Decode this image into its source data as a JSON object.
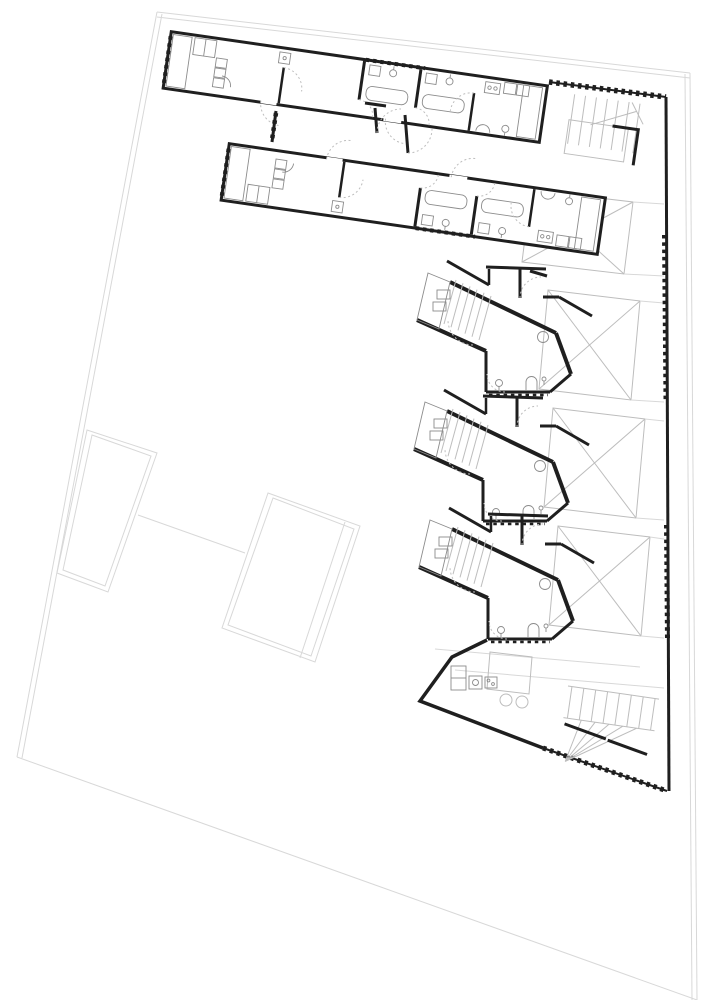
{
  "drawing": {
    "kind": "architectural-floor-plan",
    "paper_color": "#ffffff"
  },
  "colors": {
    "wall": "#1f1f1f",
    "interior_thin": "#8c8c8c",
    "light_gray": "#bdbdbd",
    "site_gray": "#d8d8d8",
    "stipple": "#8a8a8a"
  },
  "site": {
    "boundary_lines": [
      [
        157,
        12,
        690,
        73
      ],
      [
        157,
        17,
        690,
        78
      ],
      [
        157,
        12,
        17,
        757
      ],
      [
        162,
        14,
        22,
        758
      ],
      [
        690,
        73,
        697,
        1000
      ],
      [
        685,
        74,
        692,
        1000
      ],
      [
        17,
        757,
        697,
        1000
      ]
    ],
    "connector_line": [
      138,
      515,
      245,
      553
    ]
  },
  "parcels": [
    {
      "outer": [
        [
          87,
          430
        ],
        [
          157,
          453
        ],
        [
          108,
          592
        ],
        [
          57,
          573
        ]
      ],
      "inner": [
        [
          92,
          435
        ],
        [
          151,
          456
        ],
        [
          105,
          586
        ],
        [
          63,
          570
        ]
      ],
      "extra_lines": []
    },
    {
      "outer": [
        [
          268,
          493
        ],
        [
          360,
          526
        ],
        [
          315,
          662
        ],
        [
          222,
          628
        ]
      ],
      "inner": [
        [
          273,
          498
        ],
        [
          354,
          529
        ],
        [
          311,
          656
        ],
        [
          228,
          625
        ]
      ],
      "extra_lines": [
        [
          345,
          522,
          300,
          658
        ]
      ]
    }
  ],
  "courtyards": {
    "right_wall_x": 664,
    "boxes": [
      [
        [
          531,
          190
        ],
        [
          633,
          202
        ],
        [
          624,
          274
        ],
        [
          522,
          262
        ]
      ],
      [
        [
          548,
          290
        ],
        [
          640,
          301
        ],
        [
          631,
          400
        ],
        [
          539,
          389
        ]
      ],
      [
        [
          553,
          408
        ],
        [
          645,
          419
        ],
        [
          636,
          518
        ],
        [
          544,
          507
        ]
      ],
      [
        [
          558,
          526
        ],
        [
          650,
          537
        ],
        [
          641,
          636
        ],
        [
          549,
          625
        ]
      ]
    ]
  },
  "units": {
    "count": 3,
    "offsets": [
      [
        3,
        -129
      ],
      [
        0,
        0
      ],
      [
        5,
        118
      ]
    ]
  },
  "bars": {
    "count": 2,
    "transforms": [
      "translate(170,30) rotate(8.2)",
      "translate(228,142) rotate(8.2) translate(0,60) scale(1,-1)"
    ]
  }
}
